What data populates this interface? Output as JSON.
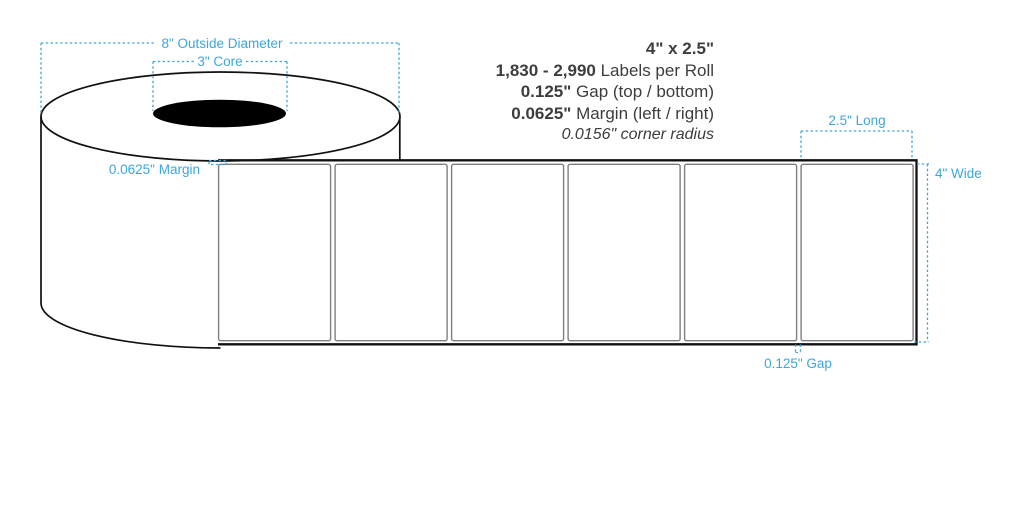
{
  "specs": {
    "size": "4\" x 2.5\"",
    "labels_per_roll_value": "1,830 - 2,990",
    "labels_per_roll_text": " Labels per Roll",
    "gap_value": "0.125\"",
    "gap_text": " Gap (top / bottom)",
    "margin_value": "0.0625\"",
    "margin_text": " Margin (left / right)",
    "corner_radius": "0.0156\" corner radius"
  },
  "annotations": {
    "outside_diameter": "8\" Outside Diameter",
    "core": "3\" Core",
    "margin": "0.0625\" Margin",
    "long": "2.5\" Long",
    "wide": "4\" Wide",
    "gap": "0.125\" Gap"
  },
  "diagram": {
    "visible_labels_on_strip": 6
  },
  "colors": {
    "accent_cyan": "#3fa6db",
    "ink_text": "#3d3d3d",
    "outline_black": "#111111",
    "label_border_gray": "#7f7f7f",
    "core_fill": "#000000",
    "background": "#ffffff"
  }
}
